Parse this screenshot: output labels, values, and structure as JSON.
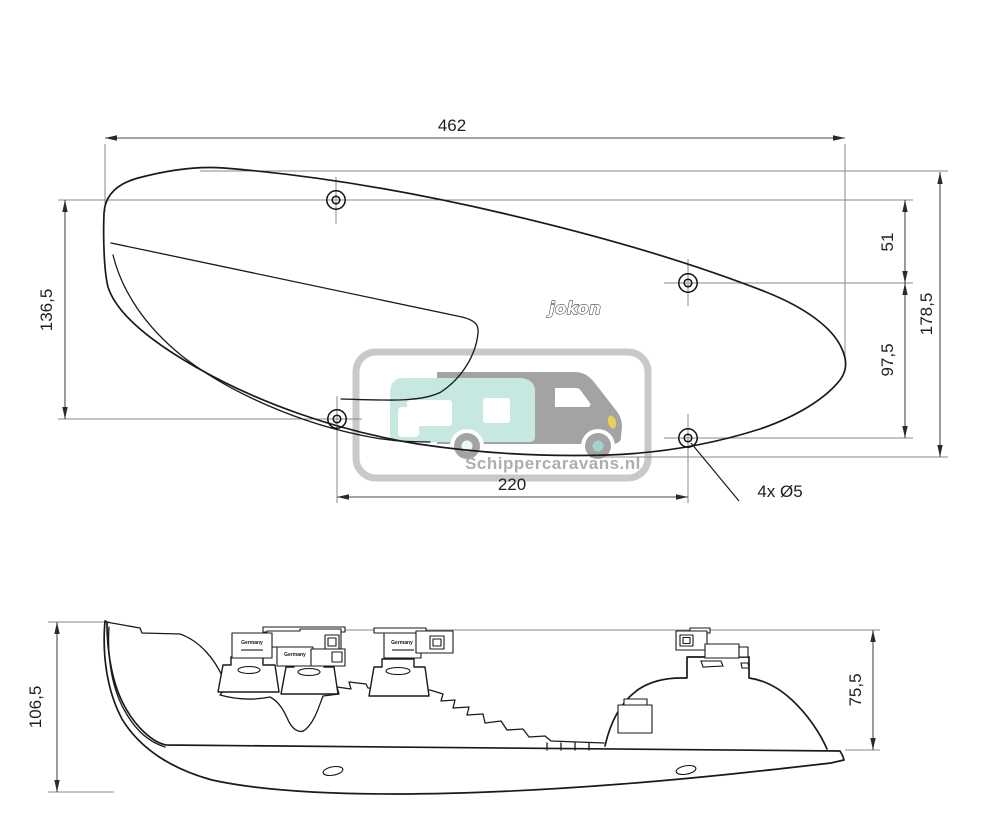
{
  "page": {
    "background": "#ffffff"
  },
  "views": {
    "front_view": {
      "brand_logo": "jokon",
      "hole_note": "4x Ø5",
      "dimensions": {
        "overall_width": "462",
        "left_hole_spacing": "136,5",
        "top_hole_offset": "51",
        "right_hole_spacing": "97,5",
        "overall_height": "178,5",
        "bottom_hole_spacing": "220"
      }
    },
    "side_view": {
      "connector_label": "Germany",
      "dimensions": {
        "overall_height": "106,5",
        "body_depth": "75,5"
      }
    }
  },
  "watermark": {
    "text": "Schippercaravans.nl",
    "colors": {
      "frame": "#c7cac9",
      "van_gray": "#a3a3a3",
      "caravan_teal": "#c7e8e1",
      "hub_teal": "#9fd6cb",
      "hub_light": "#eef7f5",
      "headlight_yellow": "#e9cf55",
      "text_gray": "#a9b0ae"
    }
  },
  "drawing_colors": {
    "outline": "#1a1a1a",
    "dimension_line": "#4a4a4a",
    "extension_line": "#8a8a8a",
    "label_text": "#1f1f1f"
  }
}
